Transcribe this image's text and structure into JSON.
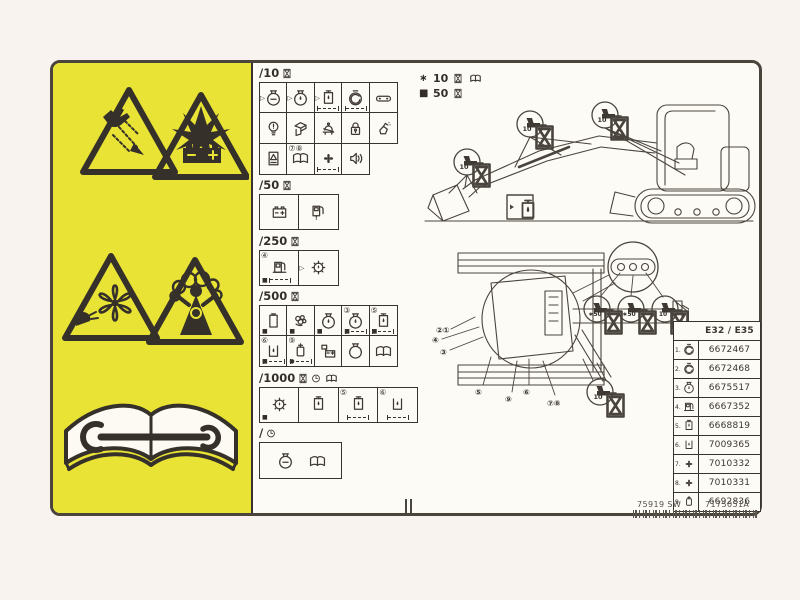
{
  "colors": {
    "panel_yellow": "#e9e335",
    "ink": "#3f3933",
    "paper": "#fdfbf6",
    "page_bg": "#f8f3ee"
  },
  "legend": {
    "rows": [
      {
        "bullet": "∗",
        "value": "10",
        "icons": [
          "hourglass",
          "book"
        ]
      },
      {
        "bullet": "■",
        "value": "50",
        "icons": [
          "hourglass"
        ]
      }
    ]
  },
  "sections": [
    {
      "label": "/10",
      "header_icons": [
        "hourglass"
      ],
      "size": "sm",
      "rows": [
        [
          {
            "icon": "pot-dash",
            "check": true
          },
          {
            "icon": "pot-drop",
            "check": true
          },
          {
            "icon": "box-drop",
            "check": true,
            "dashes": true
          },
          {
            "icon": "air-round",
            "dashes": true
          },
          {
            "icon": "link-bar"
          }
        ],
        [
          {
            "icon": "bulb"
          },
          {
            "icon": "chute"
          },
          {
            "icon": "seatbelt"
          },
          {
            "icon": "padlock"
          },
          {
            "icon": "spray"
          }
        ],
        [
          {
            "icon": "sign-box"
          },
          {
            "icon": "book",
            "badge": "⑦⑧"
          },
          {
            "icon": "fan",
            "dashes": true
          },
          {
            "icon": "horn"
          }
        ]
      ]
    },
    {
      "label": "/50",
      "header_icons": [
        "hourglass"
      ],
      "size": "lg",
      "rows": [
        [
          {
            "icon": "battery"
          },
          {
            "icon": "pump-drain"
          }
        ]
      ]
    },
    {
      "label": "/250",
      "header_icons": [
        "hourglass"
      ],
      "size": "lg",
      "rows": [
        [
          {
            "icon": "pump",
            "badge": "④",
            "marker": "■",
            "dashes": true
          },
          {
            "icon": "gear-drop",
            "check": true
          }
        ]
      ]
    },
    {
      "label": "/500",
      "header_icons": [
        "hourglass"
      ],
      "size": "sm",
      "rows": [
        [
          {
            "icon": "filter-rect",
            "marker": "■"
          },
          {
            "icon": "bearings",
            "marker": "■"
          },
          {
            "icon": "pot-drop",
            "marker": "■"
          },
          {
            "icon": "pot-drop",
            "badge": "③",
            "marker": "■",
            "dashes": true
          },
          {
            "icon": "box-drop",
            "badge": "⑤",
            "marker": "■",
            "dashes": true
          }
        ],
        [
          {
            "icon": "tank-drop",
            "badge": "⑥",
            "marker": "■",
            "dashes": true
          },
          {
            "icon": "filter-round",
            "badge": "⑨",
            "marker": "●",
            "dashes": true
          },
          {
            "icon": "battery-box"
          },
          {
            "icon": "pot-plain"
          },
          {
            "icon": "book"
          }
        ]
      ]
    },
    {
      "label": "/1000",
      "header_icons": [
        "hourglass",
        "clock",
        "book"
      ],
      "size": "lg",
      "rows": [
        [
          {
            "icon": "gear-drop",
            "marker": "■"
          },
          {
            "icon": "box-drop"
          },
          {
            "icon": "box-drop",
            "badge": "⑤",
            "dashes": true
          },
          {
            "icon": "tank-drop",
            "badge": "⑥",
            "dashes": true
          }
        ]
      ]
    },
    {
      "label": "/",
      "header_icons": [
        "clock"
      ],
      "size": "lg",
      "boxed": true,
      "rows": [
        [
          {
            "icon": "pot-dash"
          },
          {
            "icon": "book"
          }
        ]
      ]
    }
  ],
  "upper_callouts": [
    {
      "text": "10"
    },
    {
      "text": "10"
    },
    {
      "text": "10"
    }
  ],
  "lower_callouts": [
    {
      "text": "∗50"
    },
    {
      "text": "∗50"
    },
    {
      "text": "10"
    }
  ],
  "bottom_callout": {
    "text": "10"
  },
  "part_callouts": [
    "②①",
    "④",
    "③",
    "⑤",
    "⑨",
    "⑥",
    "⑦⑧"
  ],
  "table": {
    "header": "E32 / E35",
    "rows": [
      {
        "n": "1.",
        "icon": "air-round",
        "part": "6672467"
      },
      {
        "n": "2.",
        "icon": "air-round",
        "part": "6672468"
      },
      {
        "n": "3.",
        "icon": "pot-drop",
        "part": "6675517"
      },
      {
        "n": "4.",
        "icon": "pump",
        "part": "6667352"
      },
      {
        "n": "5.",
        "icon": "box-drop",
        "part": "6668819"
      },
      {
        "n": "6.",
        "icon": "tank-drop",
        "part": "7009365"
      },
      {
        "n": "7.",
        "icon": "fan",
        "part": "7010332"
      },
      {
        "n": "8.",
        "icon": "fan",
        "part": "7010331"
      },
      {
        "n": "9.",
        "icon": "filter-round",
        "part": "6692836"
      }
    ]
  },
  "footer": {
    "code_left": "75919 SW",
    "code_right": "7175051A"
  }
}
